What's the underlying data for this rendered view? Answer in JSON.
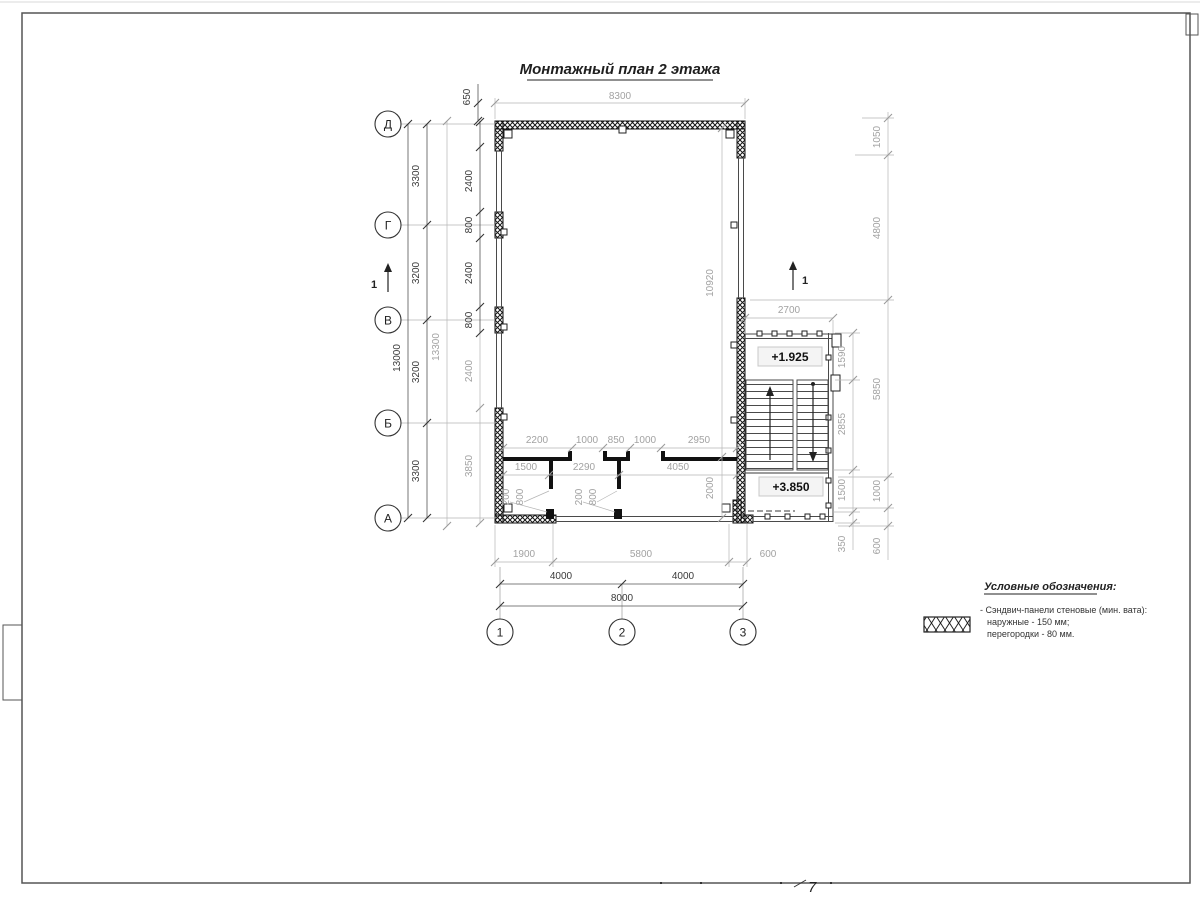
{
  "title": "Монтажный план 2 этажа",
  "colors": {
    "ink": "#2b2b2b",
    "muted": "#a8a8a8",
    "paper": "#ffffff"
  },
  "axes": {
    "left": [
      "Д",
      "Г",
      "В",
      "Б",
      "А"
    ],
    "bottom": [
      "1",
      "2",
      "3"
    ]
  },
  "dims": {
    "top": {
      "overall": "8300",
      "offset": "650"
    },
    "left": {
      "overall": "13000",
      "overall_outer": "13300",
      "spans": [
        "3300",
        "3200",
        "3200",
        "3300"
      ],
      "panels": [
        "2400",
        "800",
        "2400",
        "800",
        "2400",
        "3850"
      ]
    },
    "right": {
      "outer": [
        "1050",
        "4800",
        "5850",
        "1000",
        "600"
      ],
      "stair": [
        "1590",
        "2855",
        "1500",
        "350"
      ],
      "stair_width": "2700",
      "room_height": "10920",
      "corridor": "2000"
    },
    "interior": {
      "row1": [
        "2200",
        "1000",
        "850",
        "1000",
        "2950"
      ],
      "row2": [
        "1500",
        "2290",
        "4050"
      ],
      "doors": [
        "200",
        "800",
        "200",
        "800"
      ]
    },
    "bottom": {
      "row1": [
        "1900",
        "5800",
        "600"
      ],
      "row2": [
        "4000",
        "4000"
      ],
      "overall": "8000"
    }
  },
  "labels": {
    "elev_upper": "+1.925",
    "elev_lower": "+3.850",
    "section_left": "1",
    "section_right": "1"
  },
  "legend": {
    "title": "Условные обозначения:",
    "item_line1": "- Сэндвич-панели стеновые (мин. вата):",
    "item_line2": "наружные - 150 мм;",
    "item_line3": "перегородки - 80 мм."
  },
  "sheet": {
    "page_mark": "7"
  }
}
